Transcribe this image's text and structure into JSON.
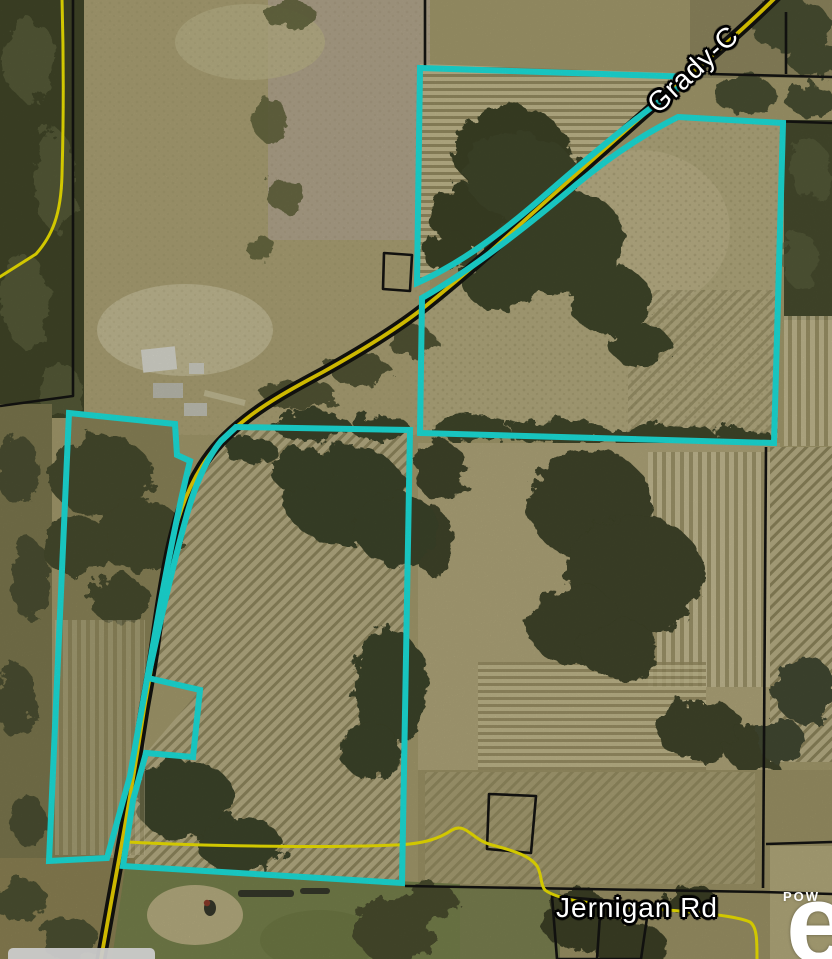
{
  "map": {
    "road_labels": [
      {
        "text": "Grady-C"
      },
      {
        "text": "Jernigan Rd"
      }
    ],
    "watermark": {
      "powered_by": "POW",
      "logo_letter": "e"
    },
    "colors": {
      "selection_highlight": "#1CE3DD",
      "road_highlight": "#EDD500",
      "minor_road": "#F2E600",
      "parcel_line": "#141412",
      "label_text": "#FFFFFF",
      "label_halo": "#000000"
    }
  }
}
